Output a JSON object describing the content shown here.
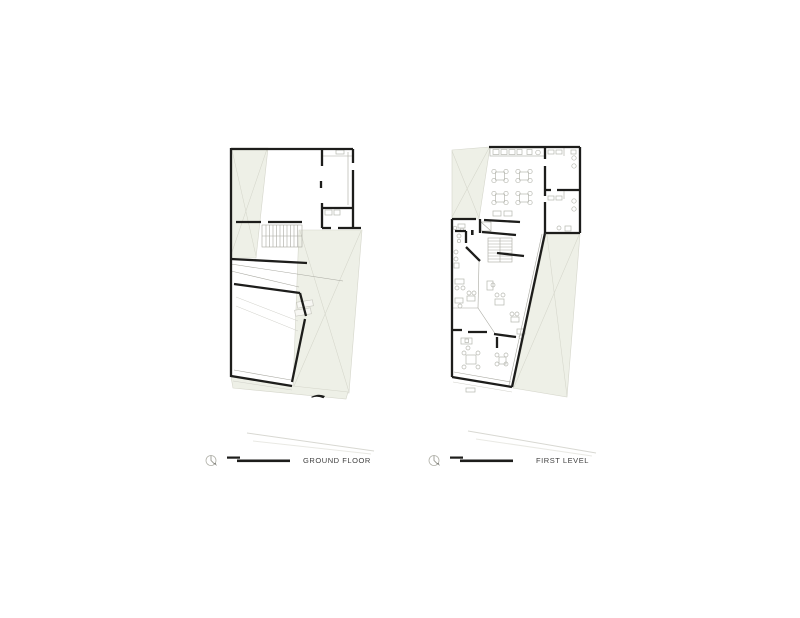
{
  "page": {
    "background": "#ffffff"
  },
  "colors": {
    "page_bg": "#ffffff",
    "site_fill": "#eef0e7",
    "site_line": "#d5d6cb",
    "wall": "#1d1d1b",
    "thin_line": "#a8a8a0",
    "furniture": "#b6b7af",
    "street_line": "#d8d8d2",
    "label_text": "#3f3f3f",
    "icon_gray": "#9a9a92"
  },
  "legends": [
    {
      "label": "GROUND FLOOR",
      "icon": "north-arrow-icon",
      "scale": "scale-bar"
    },
    {
      "label": "FIRST LEVEL",
      "icon": "north-arrow-icon",
      "scale": "scale-bar"
    }
  ]
}
